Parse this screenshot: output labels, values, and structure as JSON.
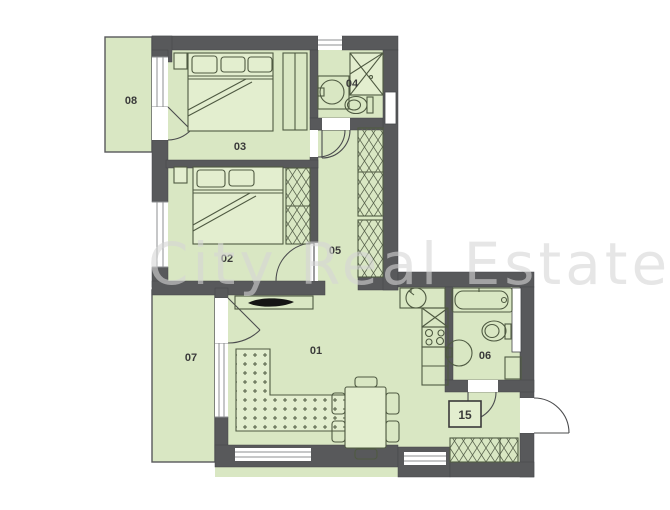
{
  "watermark": {
    "text": "City Real Estate"
  },
  "colors": {
    "floor": "#d9e7c3",
    "wall": "#58595b",
    "furnline": "#4f5a42",
    "furnfill": "#e3eecf",
    "label": "#3a3a3a",
    "watermark": "#d6d6d6"
  },
  "rooms": [
    {
      "label": "01"
    },
    {
      "label": "02"
    },
    {
      "label": "03"
    },
    {
      "label": "04"
    },
    {
      "label": "05"
    },
    {
      "label": "06"
    },
    {
      "label": "07"
    },
    {
      "label": "08"
    }
  ],
  "unit_box": {
    "label": "15"
  }
}
